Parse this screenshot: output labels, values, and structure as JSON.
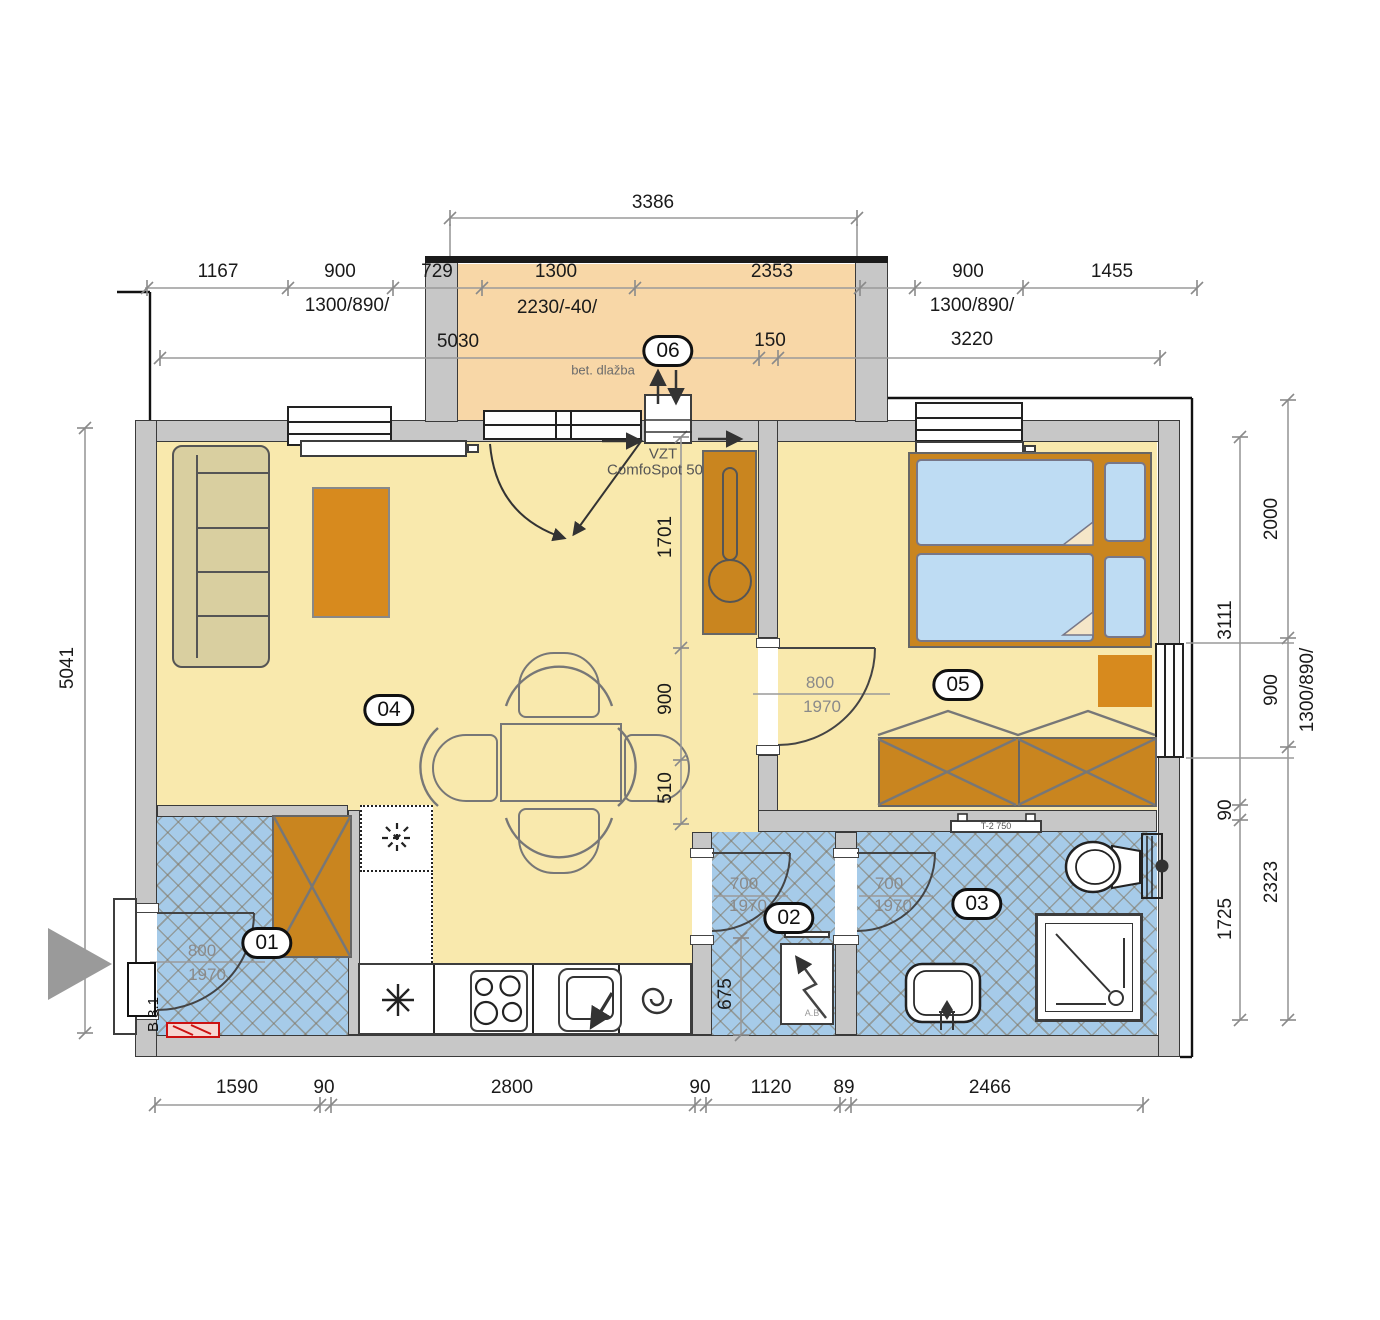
{
  "room_labels": {
    "r01": "01",
    "r02": "02",
    "r03": "03",
    "r04": "04",
    "r05": "05",
    "r06": "06"
  },
  "dims": {
    "balcony_width": "3386",
    "top_row": [
      "1167",
      "900",
      "729",
      "1300",
      "2353",
      "900",
      "1455"
    ],
    "top_window_left": "1300/890/",
    "top_door_mid": "2230/-40/",
    "top_window_right": "1300/890/",
    "row3": [
      "5030",
      "150",
      "3220"
    ],
    "left_total": "5041",
    "right_inner": [
      "3111",
      "90",
      "1725"
    ],
    "right_outer": [
      "2000",
      "900",
      "2323"
    ],
    "right_window": "1300/890/",
    "bottom": [
      "1590",
      "90",
      "2800",
      "90",
      "1120",
      "89",
      "2466"
    ],
    "hall_vertical": [
      "1701",
      "900",
      "510"
    ],
    "wc_depth": "675",
    "door_entry": [
      "800",
      "1970"
    ],
    "door_bedroom": [
      "800",
      "1970"
    ],
    "door_wc": [
      "700",
      "1970"
    ],
    "door_bath": [
      "700",
      "1970"
    ]
  },
  "annotations": {
    "vzt_line1": "VZT",
    "vzt_line2": "ComfoSpot 50",
    "balcony_floor": "bet. dlažba",
    "entry_code": "B 3.1",
    "towel_radiator": "T-2 750",
    "distribution_board": "A.B"
  },
  "colors": {
    "floor_dry": "#f9e9ad",
    "floor_balcony": "#f8d7a7",
    "floor_wet": "#a6cbe9",
    "wall": "#c7c7c7",
    "furniture": "#c9851f",
    "accent_red": "#cc1111",
    "mattress": "#bedcf3"
  }
}
